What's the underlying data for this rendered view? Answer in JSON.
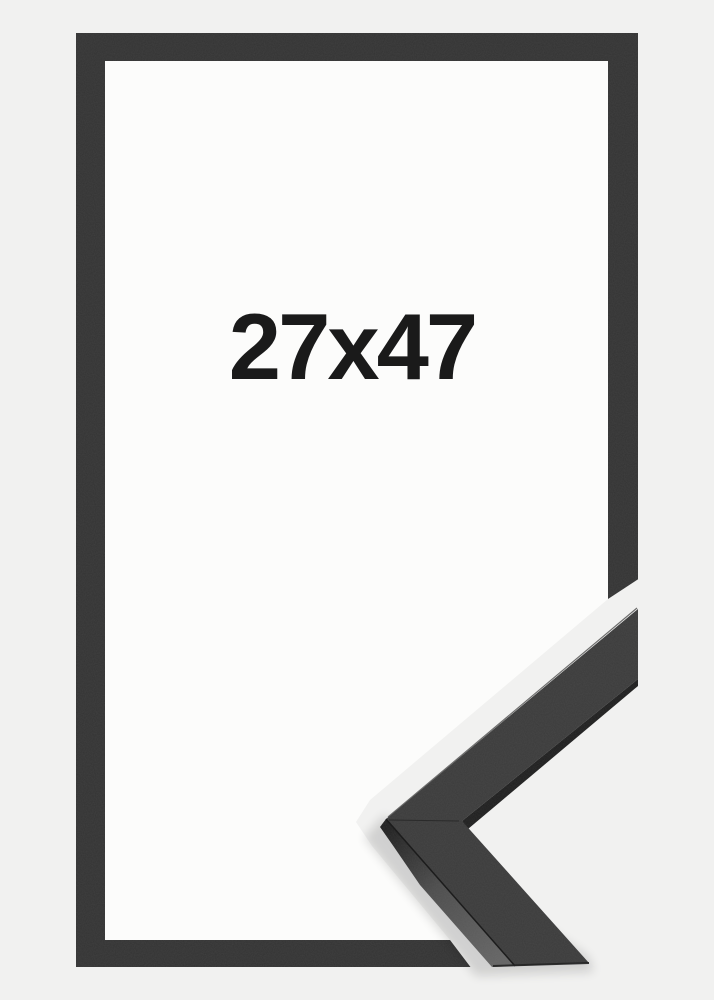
{
  "frame_preview": {
    "size_label": "27x47"
  },
  "colors": {
    "background": "#f1f1f0",
    "opening": "#fcfcfb",
    "frame": "#333333",
    "corner_face": "#3b3b3b",
    "corner_side_start": "#1f1f1f",
    "corner_side_mid": "#4d4d4d",
    "corner_side_end": "#656565",
    "corner_inner_edge": "#1e1e1e",
    "edge_highlight": "#565656",
    "face_edge": "#1c1c1c",
    "miter_seam": "#2a2a2a",
    "bottom_edge": "#242424",
    "shadow": "#000000",
    "label_text": "#1a1a1a"
  }
}
